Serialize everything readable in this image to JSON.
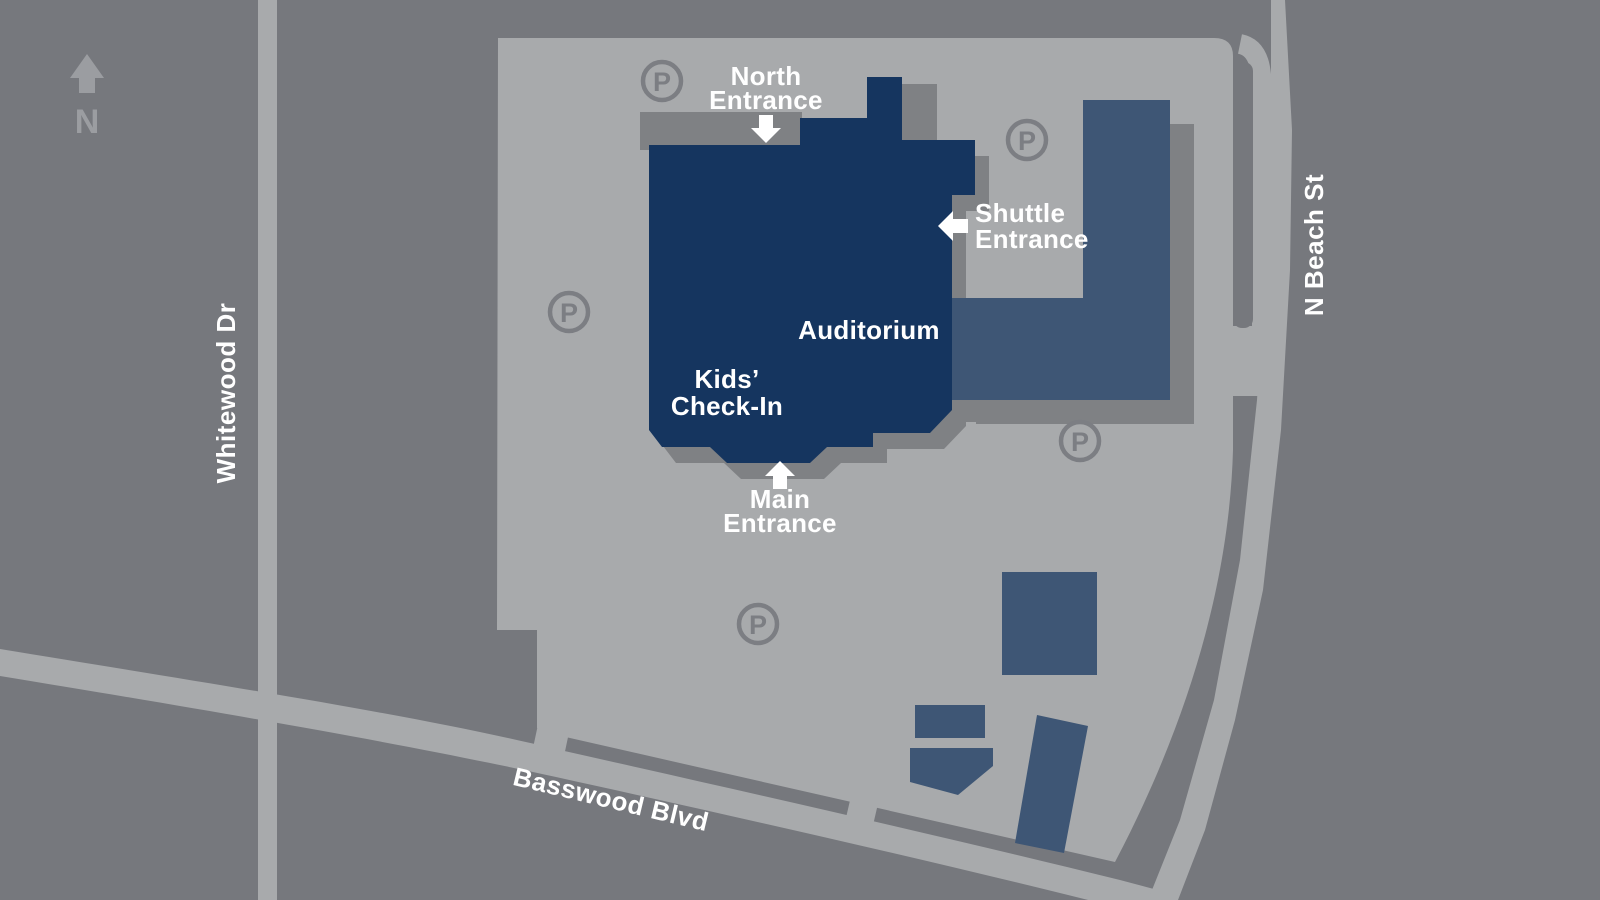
{
  "map": {
    "compass": {
      "label": "N"
    },
    "streets": {
      "whitewood": "Whitewood Dr",
      "n_beach": "N Beach St",
      "basswood": "Basswood Blvd"
    },
    "buildings": {
      "auditorium": "Auditorium",
      "kids_checkin_line1": "Kids’",
      "kids_checkin_line2": "Check-In"
    },
    "entrances": {
      "north": {
        "line1": "North",
        "line2": "Entrance",
        "arrow_direction": "down"
      },
      "shuttle": {
        "line1": "Shuttle",
        "line2": "Entrance",
        "arrow_direction": "left"
      },
      "main": {
        "line1": "Main",
        "line2": "Entrance",
        "arrow_direction": "up"
      }
    },
    "parking": {
      "symbol": "P",
      "spot_count": 5
    },
    "colors": {
      "background": "#76787d",
      "parking_lot": "#a8aaac",
      "road": "#a8aaac",
      "building_shadow": "#7f8184",
      "auditorium_building": "#15355f",
      "secondary_building": "#3e5675",
      "label_text": "#ffffff",
      "parking_icon": "#7c7e83",
      "compass": "#9b9da1"
    }
  }
}
